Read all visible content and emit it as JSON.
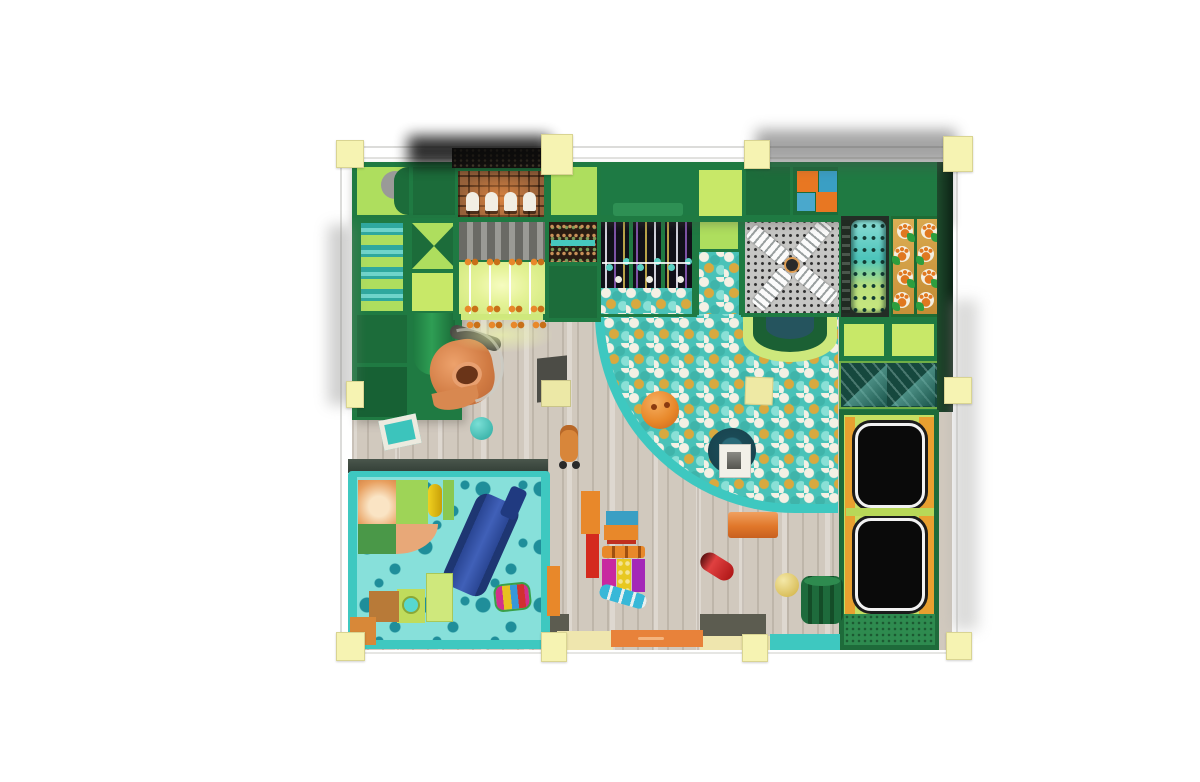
{
  "meta": {
    "description": "Top-down 3D render of an indoor soft-play playground floor plan",
    "view": "top-down",
    "canvas": {
      "width": 1200,
      "height": 782
    },
    "background": "#ffffff"
  },
  "palette": {
    "frame_green": "#1f7a42",
    "panel_light_green": "#aede5e",
    "panel_bright_green": "#c8e868",
    "panel_dark_green": "#1c6c3a",
    "teal_border": "#3ec8c0",
    "toddler_floor": "#87e0da",
    "toddler_dot": "#1f8e9a",
    "wood_floor": "#d1c9be",
    "column_yellow": "#f6f3b2",
    "ball_teal": "#49c2b8",
    "ball_white": "#f4f0e4",
    "ball_gold": "#d9a93f",
    "orange": "#e8882a",
    "blue": "#3a9fc4",
    "red": "#d42a1e",
    "magenta": "#c828a0",
    "yellow": "#e8c820",
    "trampoline_black": "#0a0a0a",
    "trampoline_rim": "#f2f2f2",
    "mat_lime": "#c6de62",
    "pad_orange": "#e8a030",
    "brick_wall": "#96613a",
    "slide_tube_orange": "#d88850",
    "toddler_slide_blue": "#2a4694",
    "windmill_platform": "#c6c6c4",
    "paw_panel_tan": "#d9a84e",
    "glass_teal": "#16483e"
  },
  "zones": [
    {
      "id": "perimeter-grid",
      "label": "structural grid with pale yellow columns"
    },
    {
      "id": "top-play-structure",
      "label": "green soft-play frame wall, top edge"
    },
    {
      "id": "left-play-structure",
      "label": "green soft-play frame wall with roller ramp and bowtie panel"
    },
    {
      "id": "brick-oven-cell",
      "label": "brick-pattern panel with four glowing arches"
    },
    {
      "id": "harp-cell",
      "label": "glowing music-string panel with bell pairs"
    },
    {
      "id": "hanging-ball-panels",
      "label": "three dark panels with hanging strings over ball pit"
    },
    {
      "id": "windmill-platform",
      "label": "perforated platform with four white windmill blades"
    },
    {
      "id": "perforated-cylinder",
      "label": "teal cylinder tower with hole grid"
    },
    {
      "id": "paw-climb-panels",
      "label": "two tan climbing strips with paw prints"
    },
    {
      "id": "ball-pit",
      "label": "quarter-round ball pit with teal rim, teal/white/gold balls"
    },
    {
      "id": "slide-dome",
      "label": "half-dome slide exit at ball pit top"
    },
    {
      "id": "spiral-slide",
      "label": "orange tube slide exiting green tower"
    },
    {
      "id": "glass-skylight",
      "label": "two glass panes with diagonal sheen"
    },
    {
      "id": "trampoline-zone",
      "label": "two black trampolines on lime and orange padding"
    },
    {
      "id": "toddler-area",
      "label": "teal polka-dot toddler zone with blue slide and soft blocks"
    },
    {
      "id": "wood-floor",
      "label": "light wooden plank floor with loose play items"
    }
  ],
  "counts": {
    "yellow_columns": 10,
    "brick_arches": 4,
    "harp_strings": 4,
    "bell_pairs_per_row": 4,
    "bell_rows": 3,
    "hanging_panels": 3,
    "strings_per_panel": 3,
    "windmill_blades": 4,
    "paw_strips": 2,
    "paws_per_strip": 4,
    "trampolines": 2,
    "glass_panes": 2
  },
  "string_colors": [
    "#e6e6f0",
    "#8a5ab5",
    "#cbb24e"
  ],
  "ball_colors": [
    "#49c2b8",
    "#f4f0e4",
    "#d9a93f",
    "#8ae0d6"
  ]
}
